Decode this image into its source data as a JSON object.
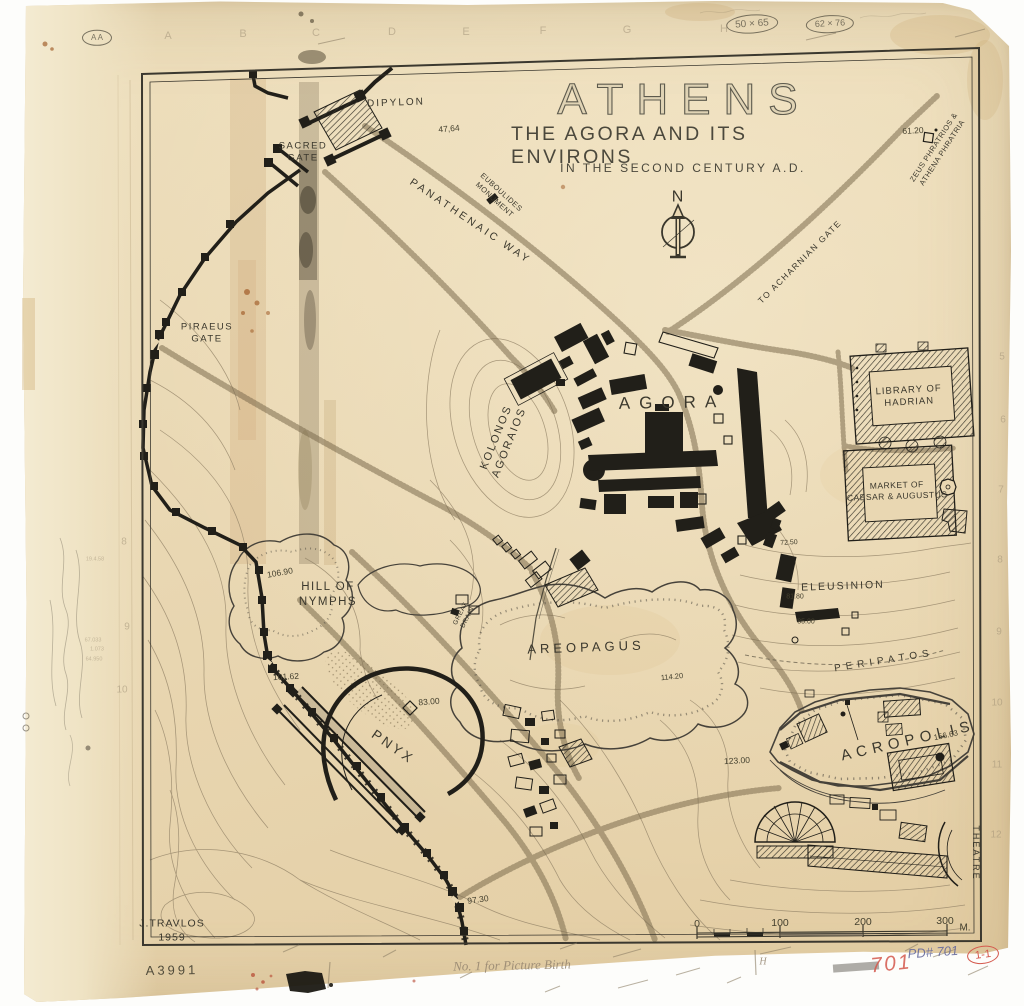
{
  "map": {
    "title": {
      "main": "ATHENS",
      "sub1": "THE AGORA AND ITS ENVIRONS",
      "sub2": "IN THE SECOND CENTURY A.D."
    },
    "north": "N",
    "place_labels": [
      {
        "name": "north-letter",
        "text": "N",
        "x": 678,
        "y": 198,
        "fs": 16,
        "ls": 1
      },
      {
        "name": "dipylon",
        "text": "DIPYLON",
        "x": 396,
        "y": 103,
        "fs": 10,
        "ls": 2,
        "rot": -2
      },
      {
        "name": "sacred-gate",
        "text": "SACRED\nGATE",
        "x": 303,
        "y": 153,
        "fs": 9.5,
        "ls": 1.5
      },
      {
        "name": "euboulides-monument",
        "text": "EUBOULIDES\nMONUMENT",
        "x": 498,
        "y": 196,
        "fs": 7.5,
        "ls": 0.5,
        "rot": 42
      },
      {
        "name": "panathenaic-way",
        "text": "PANATHENAIC  WAY",
        "x": 470,
        "y": 222,
        "fs": 10.5,
        "ls": 3,
        "rot": 34
      },
      {
        "name": "zeus-phratrios",
        "text": "ZEUS PHRATRIOS &\nATHENA PHRATRIA",
        "x": 938,
        "y": 150,
        "fs": 7.5,
        "ls": 0.5,
        "rot": -57
      },
      {
        "name": "to-acharnian-gate",
        "text": "TO ACHARNIAN GATE",
        "x": 800,
        "y": 262,
        "fs": 8.5,
        "ls": 1.5,
        "rot": -45
      },
      {
        "name": "piraeus-gate",
        "text": "PIRAEUS\nGATE",
        "x": 207,
        "y": 334,
        "fs": 9.5,
        "ls": 1.5
      },
      {
        "name": "kolonos-agoraios",
        "text": "KOLONOS\nAGORAIOS",
        "x": 503,
        "y": 440,
        "fs": 11,
        "ls": 2,
        "rot": -68
      },
      {
        "name": "agora",
        "text": "AGORA",
        "x": 672,
        "y": 403,
        "fs": 17,
        "ls": 9,
        "rot": -1
      },
      {
        "name": "library-of-hadrian",
        "text": "LIBRARY OF\nHADRIAN",
        "x": 909,
        "y": 397,
        "fs": 9.5,
        "ls": 1,
        "rot": -3
      },
      {
        "name": "market-of-caesar-augustus",
        "text": "MARKET OF\nCAESAR & AUGUSTUS",
        "x": 897,
        "y": 491,
        "fs": 8.5,
        "ls": 0.5,
        "rot": -2
      },
      {
        "name": "eleusinion",
        "text": "ELEUSINION",
        "x": 843,
        "y": 587,
        "fs": 10.5,
        "ls": 2,
        "rot": -2
      },
      {
        "name": "hill-of-nymphs",
        "text": "HILL OF\nNYMPHS",
        "x": 328,
        "y": 595,
        "fs": 11.5,
        "ls": 1.5
      },
      {
        "name": "great-drain",
        "text": "GREAT\nDRAIN",
        "x": 465,
        "y": 616,
        "fs": 6.5,
        "ls": 0.5,
        "rot": -63
      },
      {
        "name": "areopagus",
        "text": "AREOPAGUS",
        "x": 586,
        "y": 648,
        "fs": 13,
        "ls": 4,
        "rot": -2
      },
      {
        "name": "pnyx",
        "text": "PNYX",
        "x": 393,
        "y": 747,
        "fs": 13.5,
        "ls": 3,
        "rot": 35
      },
      {
        "name": "peripatos",
        "text": "PERIPATOS",
        "x": 884,
        "y": 661,
        "fs": 10,
        "ls": 5,
        "rot": -9
      },
      {
        "name": "acropolis",
        "text": "ACROPOLIS",
        "x": 908,
        "y": 741,
        "fs": 15,
        "ls": 5.5,
        "rot": -13
      },
      {
        "name": "theatre",
        "text": "THEATRE",
        "x": 975,
        "y": 853,
        "fs": 9,
        "ls": 2,
        "rot": 90
      },
      {
        "name": "credit",
        "text": "J.TRAVLOS\n1959",
        "x": 172,
        "y": 931,
        "fs": 10.5,
        "ls": 1
      }
    ],
    "elevation_labels": [
      {
        "text": "47,64",
        "x": 449,
        "y": 129,
        "rot": -5
      },
      {
        "text": "61.20",
        "x": 913,
        "y": 131,
        "rot": -3
      },
      {
        "text": "106.90",
        "x": 280,
        "y": 573,
        "rot": -10
      },
      {
        "text": "101.62",
        "x": 286,
        "y": 677,
        "rot": -3
      },
      {
        "text": "83.00",
        "x": 429,
        "y": 702,
        "rot": -5
      },
      {
        "text": "72.50",
        "x": 789,
        "y": 543,
        "rot": -3,
        "fs": 7
      },
      {
        "text": "81.80",
        "x": 795,
        "y": 597,
        "fs": 7
      },
      {
        "text": "85.00",
        "x": 806,
        "y": 622,
        "fs": 7
      },
      {
        "text": "114.20",
        "x": 672,
        "y": 677,
        "rot": -6,
        "fs": 7.5
      },
      {
        "text": "123.00",
        "x": 737,
        "y": 761,
        "rot": -3
      },
      {
        "text": "156.63",
        "x": 946,
        "y": 736,
        "rot": -12,
        "fs": 8
      },
      {
        "text": "97.30",
        "x": 478,
        "y": 900,
        "rot": -8
      }
    ],
    "scale_bar": {
      "ticks": [
        {
          "text": "0",
          "x": 697,
          "y": 925
        },
        {
          "text": "100",
          "x": 780,
          "y": 924
        },
        {
          "text": "200",
          "x": 863,
          "y": 923
        },
        {
          "text": "300",
          "x": 945,
          "y": 922
        }
      ],
      "unit": {
        "text": "M.",
        "x": 965,
        "y": 928
      }
    }
  },
  "annotations": {
    "archive_number": {
      "text": "A3991",
      "x": 172,
      "y": 971,
      "fs": 13,
      "ls": 3,
      "rot": -1
    },
    "catalog_blue": {
      "text": "PD# 701",
      "x": 933,
      "y": 953,
      "fs": 13,
      "rot": -4
    },
    "catalog_red": {
      "text": "701",
      "x": 891,
      "y": 964,
      "fs": 21,
      "rot": -6
    },
    "plate_red": {
      "text": "1-1",
      "x": 983,
      "y": 955,
      "fs": 11,
      "rot": -8
    },
    "pencil_notes": [
      {
        "text": "50 × 65",
        "x": 752,
        "y": 24,
        "cls": "circled",
        "fs": 10,
        "rot": -4
      },
      {
        "text": "62 × 76",
        "x": 830,
        "y": 24,
        "cls": "circled",
        "fs": 9,
        "rot": -3
      },
      {
        "text": "No. 1  for Picture Birth",
        "x": 512,
        "y": 966,
        "cls": "cursive",
        "fs": 13,
        "rot": -1
      },
      {
        "text": "H",
        "x": 763,
        "y": 962,
        "cls": "cursive",
        "fs": 10
      },
      {
        "text": "A A",
        "x": 97,
        "y": 38,
        "cls": "circled",
        "fs": 8
      }
    ],
    "grid_letters": [
      {
        "text": "A",
        "x": 168,
        "y": 36
      },
      {
        "text": "B",
        "x": 243,
        "y": 34
      },
      {
        "text": "C",
        "x": 316,
        "y": 33
      },
      {
        "text": "D",
        "x": 392,
        "y": 32
      },
      {
        "text": "E",
        "x": 466,
        "y": 32
      },
      {
        "text": "F",
        "x": 543,
        "y": 31
      },
      {
        "text": "G",
        "x": 627,
        "y": 30
      },
      {
        "text": "H",
        "x": 724,
        "y": 29
      }
    ],
    "margin_numbers": [
      {
        "text": "5",
        "x": 1002,
        "y": 357
      },
      {
        "text": "6",
        "x": 1003,
        "y": 420
      },
      {
        "text": "7",
        "x": 1001,
        "y": 490
      },
      {
        "text": "8",
        "x": 1000,
        "y": 560
      },
      {
        "text": "9",
        "x": 999,
        "y": 632
      },
      {
        "text": "10",
        "x": 997,
        "y": 703
      },
      {
        "text": "11",
        "x": 997,
        "y": 765
      },
      {
        "text": "12",
        "x": 996,
        "y": 835
      },
      {
        "text": "8",
        "x": 124,
        "y": 542
      },
      {
        "text": "9",
        "x": 127,
        "y": 627
      },
      {
        "text": "10",
        "x": 122,
        "y": 690
      }
    ],
    "pencil_figures": [
      {
        "text": "19.4.58",
        "x": 95,
        "y": 560
      },
      {
        "text": "67.033",
        "x": 93,
        "y": 641
      },
      {
        "text": "1.073",
        "x": 97,
        "y": 650
      },
      {
        "text": "64.950",
        "x": 94,
        "y": 660
      }
    ]
  },
  "colors": {
    "paper": "#e9d7b2",
    "ink": "#3a372c",
    "building": "#211f19",
    "contour": "#96866a",
    "road": "#7c6c4e",
    "red": "#d4584c",
    "blue_pencil": "#666a9c",
    "pencil": "#9a8b72",
    "stain": "#b98d4f"
  }
}
